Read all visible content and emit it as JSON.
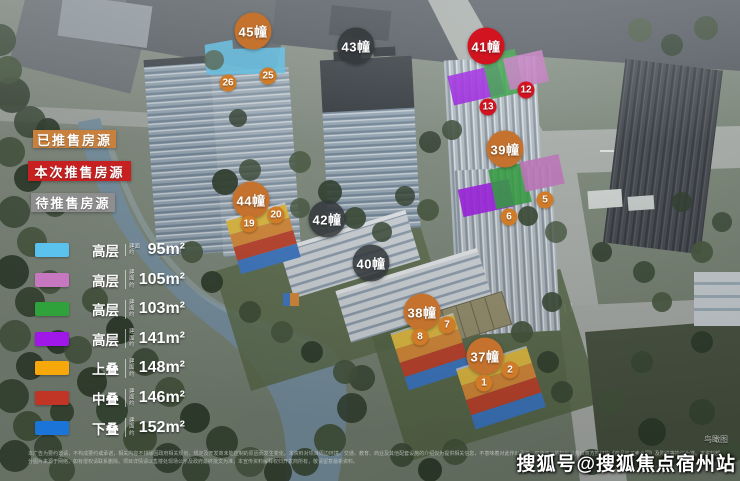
{
  "map": {
    "status_colors": {
      "sold": "#c4722e",
      "current": "#d11420",
      "pending": "rgba(52,56,60,0.87)"
    },
    "unit_colors": {
      "sold": "#d07b28",
      "current": "#d41320"
    },
    "buildings": [
      {
        "name": "45幢",
        "status": "sold",
        "x": 253,
        "y": 31,
        "units": [
          {
            "num": "26",
            "x": 228,
            "y": 83
          },
          {
            "num": "25",
            "x": 268,
            "y": 76
          }
        ]
      },
      {
        "name": "43幢",
        "status": "pending",
        "x": 356,
        "y": 46,
        "units": []
      },
      {
        "name": "41幢",
        "status": "current",
        "x": 486,
        "y": 46,
        "units": [
          {
            "num": "13",
            "x": 488,
            "y": 107
          },
          {
            "num": "12",
            "x": 526,
            "y": 90
          }
        ]
      },
      {
        "name": "39幢",
        "status": "sold",
        "x": 505,
        "y": 149,
        "units": [
          {
            "num": "6",
            "x": 509,
            "y": 217
          },
          {
            "num": "5",
            "x": 545,
            "y": 200
          }
        ]
      },
      {
        "name": "44幢",
        "status": "sold",
        "x": 251,
        "y": 200,
        "units": [
          {
            "num": "19",
            "x": 249,
            "y": 224
          },
          {
            "num": "20",
            "x": 276,
            "y": 215
          }
        ]
      },
      {
        "name": "42幢",
        "status": "pending",
        "x": 327,
        "y": 219,
        "units": []
      },
      {
        "name": "40幢",
        "status": "pending",
        "x": 371,
        "y": 263,
        "units": []
      },
      {
        "name": "38幢",
        "status": "sold",
        "x": 422,
        "y": 312,
        "units": [
          {
            "num": "8",
            "x": 420,
            "y": 337
          },
          {
            "num": "7",
            "x": 447,
            "y": 325
          }
        ]
      },
      {
        "name": "37幢",
        "status": "sold",
        "x": 485,
        "y": 356,
        "units": [
          {
            "num": "1",
            "x": 484,
            "y": 383
          },
          {
            "num": "2",
            "x": 510,
            "y": 370
          }
        ]
      }
    ]
  },
  "legend": {
    "status_labels": [
      {
        "text": "已推售房源",
        "color": "#c9803c",
        "x": 33,
        "y": 130,
        "w": 83,
        "h": 18
      },
      {
        "text": "本次推售房源",
        "color": "#c62120",
        "x": 28,
        "y": 161,
        "w": 103,
        "h": 20
      },
      {
        "text": "待推售房源",
        "color": "#8e8e8e",
        "x": 31,
        "y": 193,
        "w": 84,
        "h": 19
      }
    ],
    "unit_types": [
      {
        "color": "#5bc2ee",
        "type": "高层",
        "prefix": "建面约",
        "area": "95m²"
      },
      {
        "color": "#c776c0",
        "type": "高层",
        "prefix": "建面约",
        "area": "105m²"
      },
      {
        "color": "#2fa23c",
        "type": "高层",
        "prefix": "建面约",
        "area": "103m²"
      },
      {
        "color": "#a018e8",
        "type": "高层",
        "prefix": "建面约",
        "area": "141m²"
      },
      {
        "color": "#f6a70a",
        "type": "上叠",
        "prefix": "建面约",
        "area": "148m²"
      },
      {
        "color": "#c03525",
        "type": "中叠",
        "prefix": "建面约",
        "area": "146m²"
      },
      {
        "color": "#1b75d8",
        "type": "下叠",
        "prefix": "建面约",
        "area": "152m²"
      }
    ]
  },
  "watermark": {
    "text": "搜狐号@搜狐焦点宿州站",
    "corner_note": "鸟瞰图"
  },
  "disclaimer": "本广告为要约邀请，不构成要约或承诺，相关内容不排除因政府相关规划、规定及开发商未能控制的原因而发生变化。本资料对项目周边环境、交通、教育、商业及其他配套设施的介绍仅为提供相关信息，不意味着对此作出承诺。买卖双方的权利义务以双方签订的《商品房买卖合同》及附件等协议为准。本资料部分图片来源于网络，如有侵权请联系删除。项目详情请以售楼处现场公示及政府最终批文为准，本宣传资料解释权归开发商所有，敬请留意最新资料。"
}
